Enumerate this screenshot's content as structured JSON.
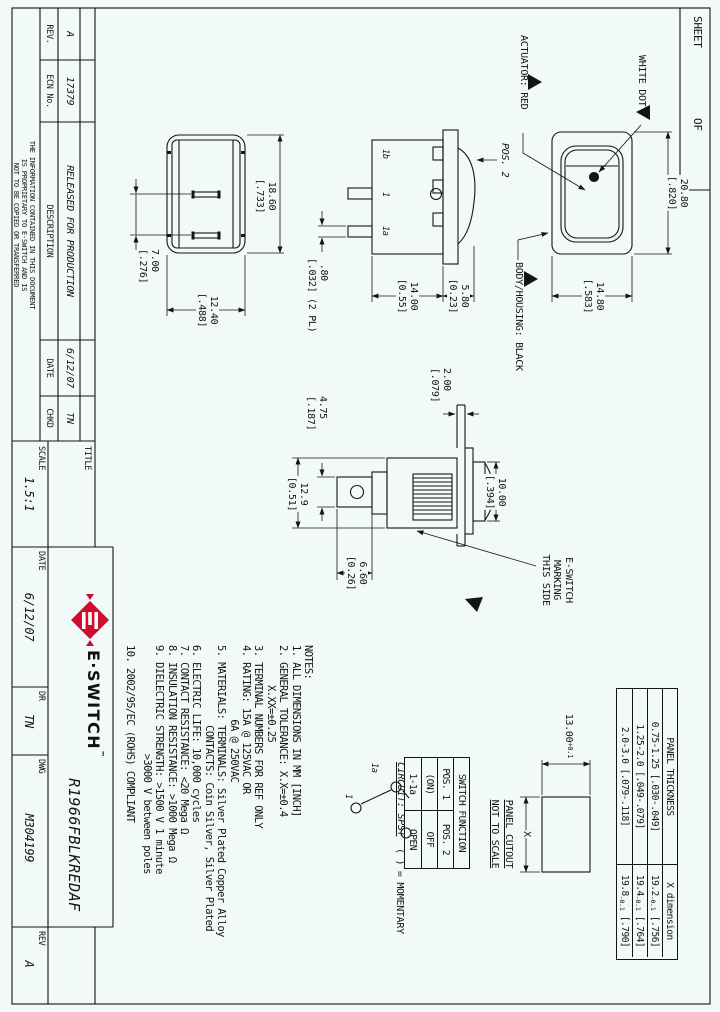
{
  "page": {
    "bg": "#f2f9f9",
    "line_color": "#141414",
    "logo_red": "#ce0e2d"
  },
  "sheet_box": {
    "sheet_label": "SHEET",
    "of_label": "OF"
  },
  "rev_table": {
    "headers": {
      "rev": "REV.",
      "ecn": "ECN No.",
      "description": "DESCRIPTION",
      "date": "DATE",
      "chkd": "CHKD"
    },
    "entry": {
      "rev": "A",
      "ecn": "17379",
      "description": "RELEASED FOR PRODUCTION",
      "date": "6/12/07",
      "chkd": "TN"
    },
    "proprietary": {
      "line1": "THE INFORMATION CONTAINED IN THIS DOCUMENT",
      "line2": "IS PROPRIETARY TO E-SWITCH AND IS",
      "line3": "NOT TO BE COPIED OR TRANSFERRED"
    }
  },
  "title_block": {
    "title_label": "TITLE",
    "part_number": "R1966FBLKREDAF",
    "logo_text": "E·SWITCH",
    "logo_tm": "™",
    "scale_label": "SCALE",
    "scale_value": "1.5:1",
    "date_label": "DATE",
    "date_value": "6/12/07",
    "dr_label": "DR",
    "dr_value": "TN",
    "dwg_label": "DWG",
    "dwg_value": "M304199",
    "rev_label": "REV",
    "rev_value": "A"
  },
  "labels": {
    "white_dot": "WHITE DOT",
    "actuator": "ACTUATOR: RED",
    "body_housing": "BODY/HOUSING: BLACK",
    "pos2": "POS. 2",
    "term_1b": "1b",
    "term_1": "1",
    "term_1a": "1a",
    "marking": "E-SWITCH\nMARKING\nTHIS SIDE"
  },
  "dims": {
    "front_width": "20.80\n[.820]",
    "front_height": "14.80\n[.583]",
    "rocker_height": "5.80\n[0.23]",
    "body_height": "14.00\n[0.55]",
    "term_thickness": " .80\n[.032] (2 PL)",
    "base_width": "18.60\n[.733]",
    "base_height": "12.40\n[.488]",
    "term_spacing": "7.00\n[.276]",
    "panel_thickness": "2.00\n[.079]",
    "bezel_width": "10.00\n[.394]",
    "blade_width": "4.75\n[.187]",
    "body_width": "12.9\n[0.51]",
    "blade_length": "6.60\n[0.26]"
  },
  "notes": {
    "lines": [
      "NOTES:",
      "1. ALL DIMENSIONS IN MM [INCH]",
      "2. GENERAL TOLERANCE: X.X=±0.4",
      "       X.XX=±0.25",
      "3. TERMINAL NUMBERS FOR REF ONLY",
      "4. RATING: 15A @ 125VAC OR",
      "             6A @ 250VAC",
      "5. MATERIALS: TERMINALS: Silver Plated Copper Alloy",
      "              CONTACTS: Coin Silver, Silver Plated",
      "6. ELECTRIC LIFE: 10,000 cycles",
      "7. CONTACT RESISTANCE: <20 Mega Ω",
      "8. INSULATION RESISTANCE: >1000 Mega Ω",
      "9. DIELECTRIC STRENGTH: >1500 V 1 minute",
      "                   >3000 V between poles",
      "10. 2002/95/EC (ROHS) COMPLIANT"
    ]
  },
  "circuit": {
    "title": "CIRCUIT: SPST",
    "momentary": "( ) = MOMENTARY",
    "term_1a": "1a",
    "term_1": "1"
  },
  "panel_table": {
    "col1_header": "PANEL THICKNESS",
    "col2_header": "X dimension",
    "rows": [
      {
        "range": "0.75-1.25 [.030-.049]",
        "x": "19.2",
        "tol": "-0.1",
        "inch": " [.756]"
      },
      {
        "range": "1.25-2.0 [.049-.079]",
        "x": "19.4",
        "tol": "-0.1",
        "inch": " [.764]"
      },
      {
        "range": "2.0-3.0 [.079-.118]",
        "x": "19.8",
        "tol": "-0.1",
        "inch": " [.790]"
      }
    ]
  },
  "function_table": {
    "title": "SWITCH FUNCTION",
    "col1": "POS. 1",
    "col2": "POS. 2",
    "r1c1": "(ON)",
    "r1c2": "OFF",
    "r2c1": "1-1a",
    "r2c2": "OPEN"
  },
  "cutout": {
    "height_dim": "13.00",
    "height_tol": "+0.1",
    "x_label": "X",
    "title": "PANEL CUTOUT",
    "subtitle": "NOT TO SCALE"
  }
}
